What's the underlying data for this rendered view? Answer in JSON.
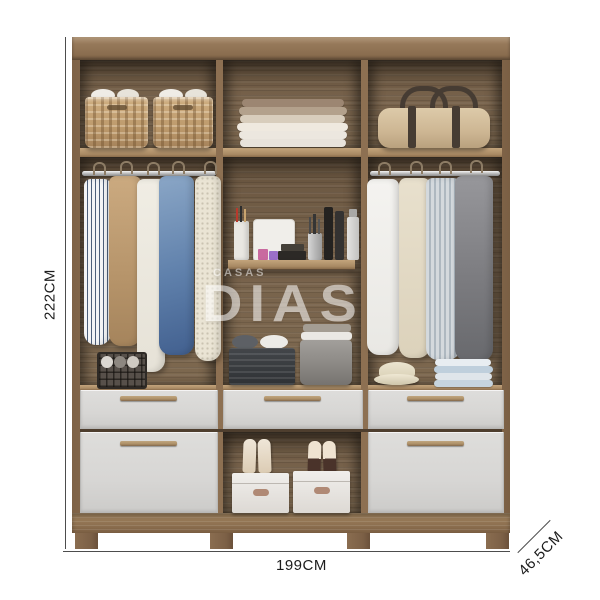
{
  "watermark": {
    "top": "CASAS",
    "main": "DIAS"
  },
  "dimensions": {
    "height_label": "222CM",
    "width_label": "199CM",
    "depth_label": "46,5CM"
  },
  "colors": {
    "frame_wood": "#8b6e4f",
    "interior_wood": "#74604a",
    "shelf_edge": "#b2946f",
    "drawer_front": "#d9d8d6",
    "drawer_handle": "#ad8f67",
    "dimension_line": "#4d4d4d",
    "label_text": "#1c1c1c",
    "watermark_white": "#ffffff"
  }
}
